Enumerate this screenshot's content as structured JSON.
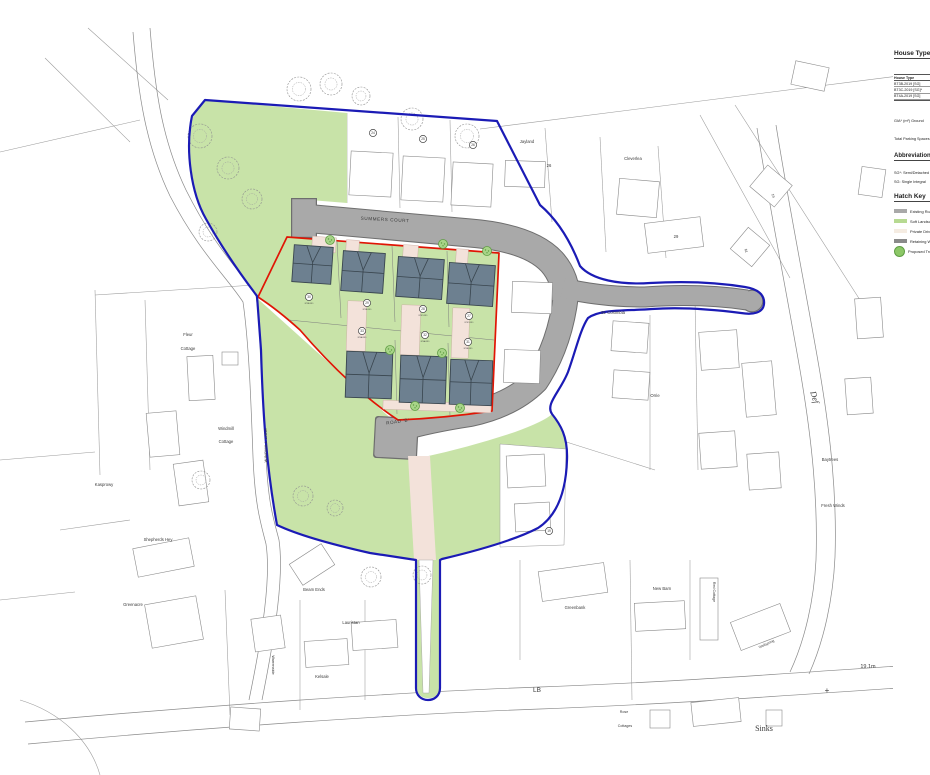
{
  "colors": {
    "soft_landscaping": "#c8e3a8",
    "road_gray": "#a9a9a9",
    "road_edge": "#6e6e6e",
    "private_drive": "#f3e2da",
    "roof": "#6d8090",
    "roof_edge": "#39454e",
    "boundary_red": "#e01505",
    "boundary_blue": "#1b1bb5",
    "parcel_line": "#9a9a9a",
    "tree_fill": "#a8d488",
    "tree_edge": "#5f9e44"
  },
  "panel": {
    "house_type_heading": "House Type",
    "table_header": "House Type",
    "table_rows": [
      "BT3B-2019 [SG]",
      "BT3C-2019 [SG]*",
      "BT4A-2019 [SG]"
    ],
    "gia_note": "GIA* (m²) Ground",
    "parking_note": "Total Parking Spaces",
    "abbreviations_heading": "Abbreviations",
    "abbrev_line1": "SG*: Semi/Detached",
    "abbrev_line2": "SG: Single Integral",
    "hatch_key_heading": "Hatch Key",
    "legend": [
      {
        "label": "Existing Road",
        "type": "swatch",
        "color": "#a9a9a9"
      },
      {
        "label": "Soft Landscaping",
        "type": "swatch",
        "color": "#b7da92"
      },
      {
        "label": "Private Drive",
        "type": "swatch",
        "color": "#f5ece2"
      },
      {
        "label": "Retaining Wall",
        "type": "swatch",
        "color": "#8a8a8a"
      },
      {
        "label": "Proposed Tree",
        "type": "tree",
        "color": "#8cc767"
      }
    ]
  },
  "map": {
    "road_labels": [
      {
        "text": "SUMMERS COURT",
        "x": 385,
        "y": 221,
        "size": 4.6,
        "rot": 3,
        "spacing": 0.6
      },
      {
        "text": "ROAD 'B'",
        "x": 398,
        "y": 423,
        "size": 4.6,
        "rot": -8,
        "spacing": 0.5
      },
      {
        "text": "WINDMILL LANE",
        "x": 267,
        "y": 445,
        "size": 3.8,
        "rot": -90,
        "spacing": 0.4
      }
    ],
    "labels": [
      {
        "text": "Fleur",
        "x": 188,
        "y": 336,
        "size": 4.2
      },
      {
        "text": "Cottage",
        "x": 188,
        "y": 350,
        "size": 4.2
      },
      {
        "text": "Windmill",
        "x": 226,
        "y": 430,
        "size": 4.2
      },
      {
        "text": "Cottage",
        "x": 226,
        "y": 443,
        "size": 4.2
      },
      {
        "text": "Kasprowy",
        "x": 104,
        "y": 486,
        "size": 4.2
      },
      {
        "text": "Shepherds Hey",
        "x": 158,
        "y": 541,
        "size": 4.2
      },
      {
        "text": "Greenacre",
        "x": 133,
        "y": 606,
        "size": 4.2
      },
      {
        "text": "Beam Ends",
        "x": 314,
        "y": 591,
        "size": 4.2
      },
      {
        "text": "Lauristan",
        "x": 351,
        "y": 624,
        "size": 4.2
      },
      {
        "text": "Kelsale",
        "x": 322,
        "y": 678,
        "size": 4.2
      },
      {
        "text": "Warrenside",
        "x": 272,
        "y": 665,
        "size": 3.8,
        "rot": 90
      },
      {
        "text": "St. Colombia",
        "x": 613,
        "y": 314,
        "size": 4.2
      },
      {
        "text": "Orrie",
        "x": 655,
        "y": 397,
        "size": 4.2
      },
      {
        "text": "Baytrees",
        "x": 830,
        "y": 461,
        "size": 4.2
      },
      {
        "text": "Fresh Winds",
        "x": 833,
        "y": 507,
        "size": 4.2
      },
      {
        "text": "Def",
        "x": 812,
        "y": 398,
        "size": 8.5,
        "rot": 73,
        "serif": true,
        "italic": true
      },
      {
        "text": "Jayland",
        "x": 527,
        "y": 143,
        "size": 4.2
      },
      {
        "text": "26",
        "x": 549,
        "y": 167,
        "size": 4.2
      },
      {
        "text": "Cleverlea",
        "x": 633,
        "y": 160,
        "size": 4.2
      },
      {
        "text": "29",
        "x": 676,
        "y": 238,
        "size": 4.2
      },
      {
        "text": "19",
        "x": 772,
        "y": 196,
        "size": 3.5,
        "rot": 75
      },
      {
        "text": "61",
        "x": 745,
        "y": 251,
        "size": 3.5,
        "rot": 75
      },
      {
        "text": "Greenbank",
        "x": 575,
        "y": 609,
        "size": 4.2
      },
      {
        "text": "New Barn",
        "x": 662,
        "y": 590,
        "size": 4.2
      },
      {
        "text": "Red Cottage",
        "x": 713,
        "y": 592,
        "size": 3.6,
        "rot": 90
      },
      {
        "text": "Wellspring",
        "x": 767,
        "y": 645,
        "size": 3.6,
        "rot": -25
      },
      {
        "text": "LB",
        "x": 537,
        "y": 692,
        "size": 6.5
      },
      {
        "text": "Rose",
        "x": 624,
        "y": 713,
        "size": 3.6
      },
      {
        "text": "Cottages",
        "x": 625,
        "y": 727,
        "size": 3.6
      },
      {
        "text": "Sinks",
        "x": 764,
        "y": 731,
        "size": 8,
        "serif": true
      },
      {
        "text": "19.1m",
        "x": 868,
        "y": 668,
        "size": 5.5
      },
      {
        "text": "+",
        "x": 827,
        "y": 693,
        "size": 8,
        "color": "#777777"
      }
    ],
    "markers": [
      {
        "n": "24",
        "x": 373,
        "y": 133,
        "code": ""
      },
      {
        "n": "25",
        "x": 423,
        "y": 139,
        "code": ""
      },
      {
        "n": "26",
        "x": 473,
        "y": 145,
        "code": ""
      },
      {
        "n": "30",
        "x": 309,
        "y": 297,
        "code": "BT3B-2019"
      },
      {
        "n": "29",
        "x": 367,
        "y": 303,
        "code": "BT3B-2019"
      },
      {
        "n": "28",
        "x": 423,
        "y": 309,
        "code": "BT3C-2019"
      },
      {
        "n": "27",
        "x": 469,
        "y": 316,
        "code": "BT3C-2019"
      },
      {
        "n": "33",
        "x": 362,
        "y": 331,
        "code": "BT4A-2019"
      },
      {
        "n": "32",
        "x": 425,
        "y": 335,
        "code": "BT4A-2019"
      },
      {
        "n": "31",
        "x": 468,
        "y": 342,
        "code": "BT3B-2019"
      },
      {
        "n": "19",
        "x": 549,
        "y": 531,
        "code": ""
      }
    ],
    "roofs": [
      [
        293,
        246,
        39,
        37,
        4
      ],
      [
        342,
        252,
        42,
        40,
        4
      ],
      [
        397,
        258,
        46,
        40,
        4
      ],
      [
        448,
        264,
        46,
        41,
        4
      ],
      [
        346,
        352,
        46,
        46,
        2
      ],
      [
        400,
        356,
        46,
        47,
        2
      ],
      [
        450,
        360,
        42,
        45,
        2
      ]
    ],
    "buildings": [
      [
        350,
        152,
        42,
        44,
        3
      ],
      [
        402,
        157,
        42,
        44,
        3
      ],
      [
        452,
        163,
        40,
        43,
        3
      ],
      [
        505,
        161,
        40,
        26,
        2
      ],
      [
        618,
        180,
        40,
        36,
        5
      ],
      [
        646,
        220,
        56,
        30,
        -7
      ],
      [
        755,
        172,
        32,
        28,
        40
      ],
      [
        736,
        233,
        28,
        28,
        40
      ],
      [
        793,
        64,
        34,
        24,
        12
      ],
      [
        860,
        168,
        24,
        28,
        8
      ],
      [
        856,
        298,
        26,
        40,
        -4
      ],
      [
        846,
        378,
        26,
        36,
        -4
      ],
      [
        512,
        282,
        40,
        31,
        2
      ],
      [
        504,
        350,
        36,
        33,
        2
      ],
      [
        507,
        455,
        38,
        32,
        -3
      ],
      [
        515,
        503,
        35,
        28,
        -3
      ],
      [
        612,
        322,
        36,
        30,
        4
      ],
      [
        700,
        331,
        38,
        38,
        -4
      ],
      [
        613,
        371,
        36,
        28,
        4
      ],
      [
        744,
        362,
        30,
        54,
        -5
      ],
      [
        700,
        432,
        36,
        36,
        -4
      ],
      [
        748,
        453,
        32,
        36,
        -4
      ],
      [
        188,
        356,
        26,
        44,
        -3
      ],
      [
        148,
        412,
        30,
        44,
        -5
      ],
      [
        222,
        352,
        16,
        13,
        0
      ],
      [
        176,
        462,
        30,
        42,
        -8
      ],
      [
        135,
        543,
        57,
        29,
        -11
      ],
      [
        148,
        600,
        52,
        44,
        -10
      ],
      [
        293,
        552,
        38,
        25,
        -33
      ],
      [
        352,
        621,
        45,
        28,
        -4
      ],
      [
        305,
        640,
        43,
        26,
        -4
      ],
      [
        253,
        617,
        30,
        33,
        -8
      ],
      [
        540,
        567,
        66,
        30,
        -8
      ],
      [
        635,
        602,
        50,
        28,
        -3
      ],
      [
        700,
        578,
        18,
        62,
        0
      ],
      [
        734,
        612,
        53,
        30,
        -21
      ],
      [
        230,
        708,
        30,
        22,
        4
      ],
      [
        650,
        710,
        20,
        18,
        0
      ],
      [
        692,
        700,
        48,
        24,
        -6
      ],
      [
        766,
        710,
        16,
        16,
        0
      ]
    ],
    "proposed_trees": [
      [
        330,
        240
      ],
      [
        443,
        244
      ],
      [
        487,
        251
      ],
      [
        390,
        350
      ],
      [
        442,
        353
      ],
      [
        415,
        406
      ],
      [
        460,
        408
      ]
    ],
    "existing_trees": [
      [
        200,
        136,
        12
      ],
      [
        228,
        168,
        11
      ],
      [
        252,
        199,
        10
      ],
      [
        208,
        232,
        9
      ],
      [
        299,
        89,
        12
      ],
      [
        331,
        84,
        11
      ],
      [
        361,
        96,
        9
      ],
      [
        412,
        119,
        11
      ],
      [
        467,
        136,
        12
      ],
      [
        303,
        496,
        10
      ],
      [
        335,
        508,
        8
      ],
      [
        371,
        577,
        10
      ],
      [
        422,
        575,
        9
      ],
      [
        201,
        480,
        9
      ]
    ]
  }
}
